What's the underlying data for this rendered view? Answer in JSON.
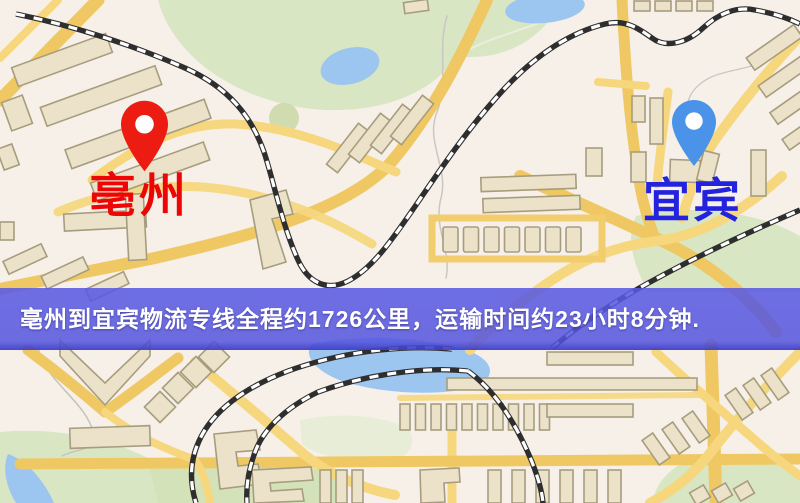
{
  "image": {
    "type": "logistics-route-map",
    "width": 800,
    "height": 503
  },
  "banner": {
    "text": "亳州到宜宾物流专线全程约1726公里，运输时间约23小时8分钟.",
    "background_color": "#5454de",
    "text_color": "#ffffff"
  },
  "markers": {
    "origin": {
      "label": "亳州",
      "pin": "red-map-pin",
      "pin_color": "#ec1c12",
      "label_color": "#ee0606"
    },
    "destination": {
      "label": "宜宾",
      "pin": "blue-map-pin",
      "pin_color": "#4b93e8",
      "label_color": "#2323dd"
    }
  },
  "route_info": {
    "origin": "亳州",
    "destination": "宜宾",
    "service": "物流专线",
    "distance_km": 1726,
    "duration": "23小时8分钟"
  },
  "map_theme": {
    "background": "#f6f0e9",
    "road_major": "#efc863",
    "road_minor": "#f6d77e",
    "building_fill": "#ebe2c9",
    "building_stroke": "#a79d7e",
    "park_green": "#d9e6c3",
    "water_blue": "#9cc6ef",
    "railway_dark": "#2e2e2e"
  }
}
